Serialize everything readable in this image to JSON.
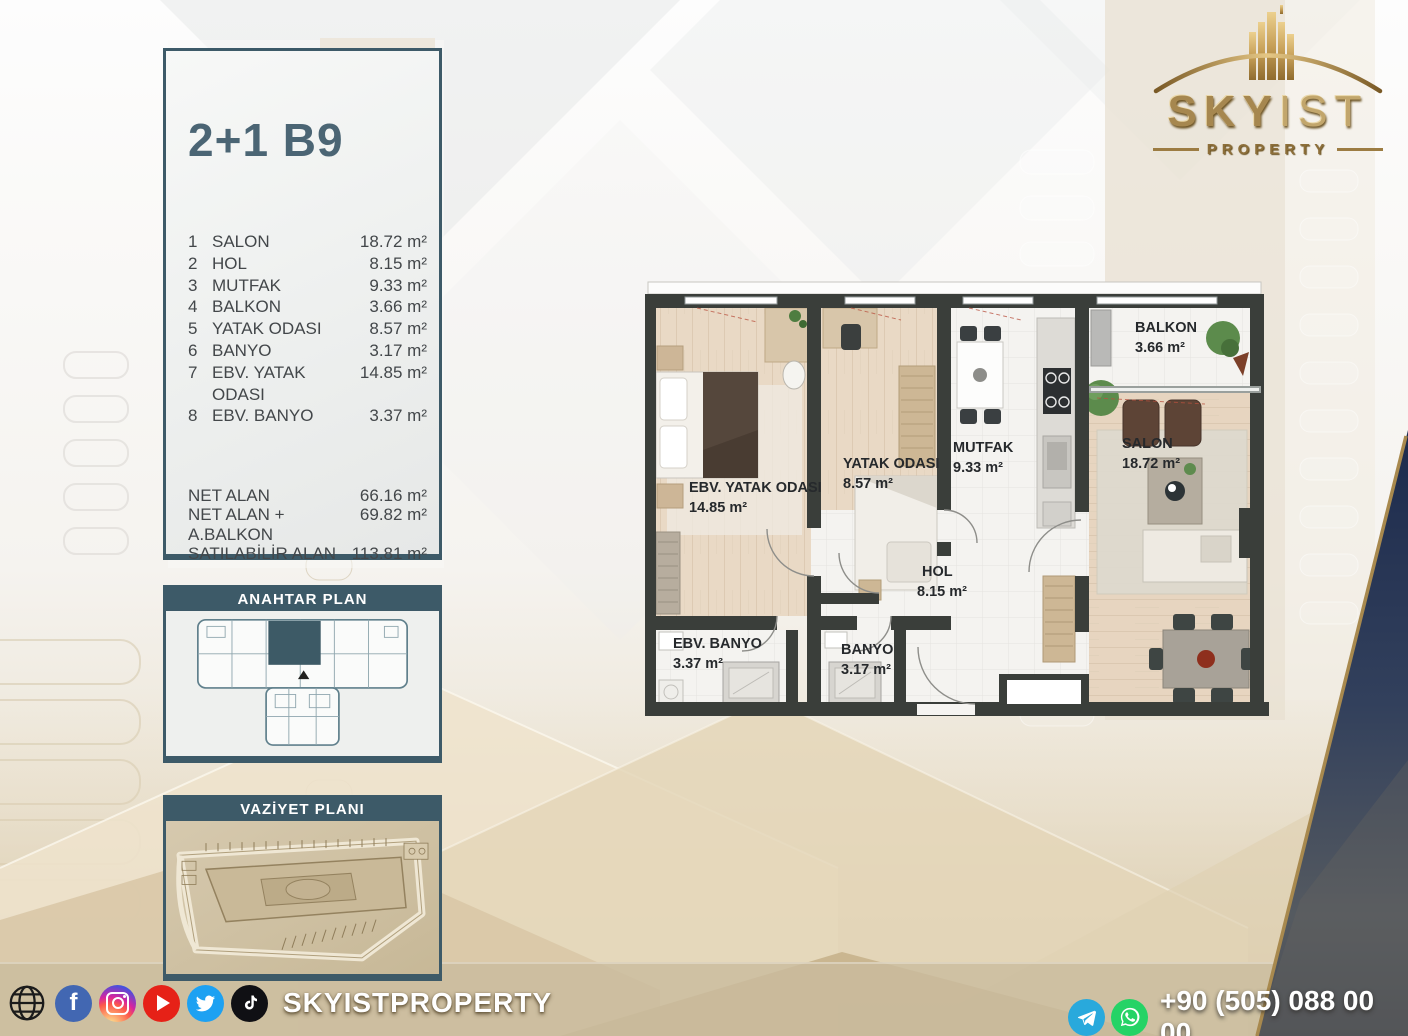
{
  "unit_card": {
    "title": "2+1 B9",
    "rooms": [
      {
        "num": "1",
        "name": "SALON",
        "area": "18.72 m²"
      },
      {
        "num": "2",
        "name": "HOL",
        "area": "8.15 m²"
      },
      {
        "num": "3",
        "name": "MUTFAK",
        "area": "9.33 m²"
      },
      {
        "num": "4",
        "name": "BALKON",
        "area": "3.66 m²"
      },
      {
        "num": "5",
        "name": "YATAK ODASI",
        "area": "8.57 m²"
      },
      {
        "num": "6",
        "name": "BANYO",
        "area": "3.17 m²"
      },
      {
        "num": "7",
        "name": "EBV. YATAK ODASI",
        "area": "14.85 m²"
      },
      {
        "num": "8",
        "name": "EBV. BANYO",
        "area": "3.37 m²"
      }
    ],
    "totals": [
      {
        "name": "NET ALAN",
        "value": "66.16 m²"
      },
      {
        "name": "NET ALAN + A.BALKON",
        "value": "69.82 m²"
      },
      {
        "name": "SATILABİLİR ALAN",
        "value": "113.81 m²"
      }
    ]
  },
  "key_plan": {
    "title": "ANAHTAR PLAN"
  },
  "site_plan": {
    "title": "VAZİYET PLANI"
  },
  "logo": {
    "brand_bold": "SKY",
    "brand_light": "IST",
    "subtitle": "PROPERTY"
  },
  "floor_plan": {
    "rooms": [
      {
        "name": "EBV. YATAK ODASI",
        "area": "14.85 m²"
      },
      {
        "name": "YATAK ODASI",
        "area": "8.57 m²"
      },
      {
        "name": "MUTFAK",
        "area": "9.33 m²"
      },
      {
        "name": "BALKON",
        "area": "3.66 m²"
      },
      {
        "name": "SALON",
        "area": "18.72 m²"
      },
      {
        "name": "HOL",
        "area": "8.15 m²"
      },
      {
        "name": "EBV. BANYO",
        "area": "3.37 m²"
      },
      {
        "name": "BANYO",
        "area": "3.17 m²"
      }
    ]
  },
  "footer": {
    "handle": "SKYISTPROPERTY",
    "phone": "+90 (505) 088 00 00",
    "social_icons": [
      "globe",
      "facebook",
      "instagram",
      "youtube",
      "twitter",
      "tiktok"
    ],
    "contact_icons": [
      "telegram",
      "whatsapp"
    ]
  },
  "colors": {
    "accent_teal": "#3d5a68",
    "wall_dark": "#3a3e3a",
    "gold": "#a6874f",
    "navy_wedge": "#1d2b4d",
    "sand": "#d3c3a3"
  }
}
